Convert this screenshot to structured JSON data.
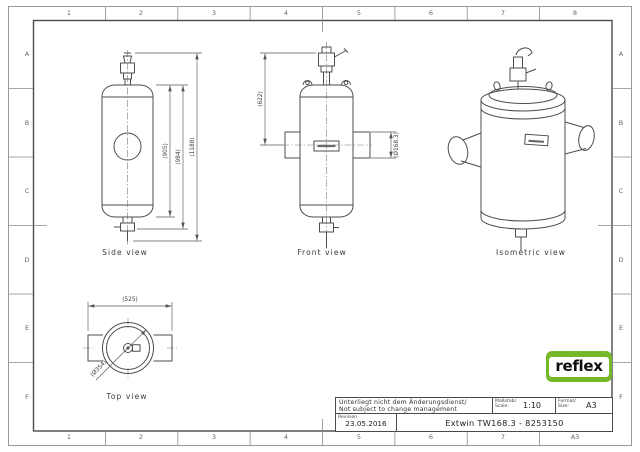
{
  "border": {
    "top": [
      "1",
      "2",
      "3",
      "4",
      "5",
      "6",
      "7",
      "8"
    ],
    "bottom": [
      "1",
      "2",
      "3",
      "4",
      "5",
      "6",
      "7",
      "A3"
    ],
    "left": [
      "A",
      "B",
      "C",
      "D",
      "E",
      "F"
    ],
    "right": [
      "A",
      "B",
      "C",
      "D",
      "E",
      "F"
    ]
  },
  "views": {
    "side": {
      "caption": "Side view",
      "dim_shell": "(905)",
      "dim_vessel": "(984)",
      "dim_total": "(1188)"
    },
    "front": {
      "caption": "Front view",
      "dim_height": "(622)",
      "dim_nozzle": "(Ø168.3)"
    },
    "isometric": {
      "caption": "Isometric view"
    },
    "top": {
      "caption": "Top view",
      "dim_width": "(525)",
      "dim_diameter": "(Ø354)"
    }
  },
  "title_block": {
    "note_de": "Unterliegt nicht dem Änderungsdienst/",
    "note_en": "Not subject to change management",
    "scale_label_de": "Maßstab/",
    "scale_label_en": "Scale:",
    "scale_value": "1:10",
    "format_label_de": "Format/",
    "format_label_en": "Size:",
    "format_value": "A3",
    "revision_label": "Revision",
    "revision_date": "23.05.2016",
    "drawing_title": "Extwin TW168.3 - 8253150"
  },
  "logo": {
    "text": "reflex",
    "color": "#76b82a"
  }
}
